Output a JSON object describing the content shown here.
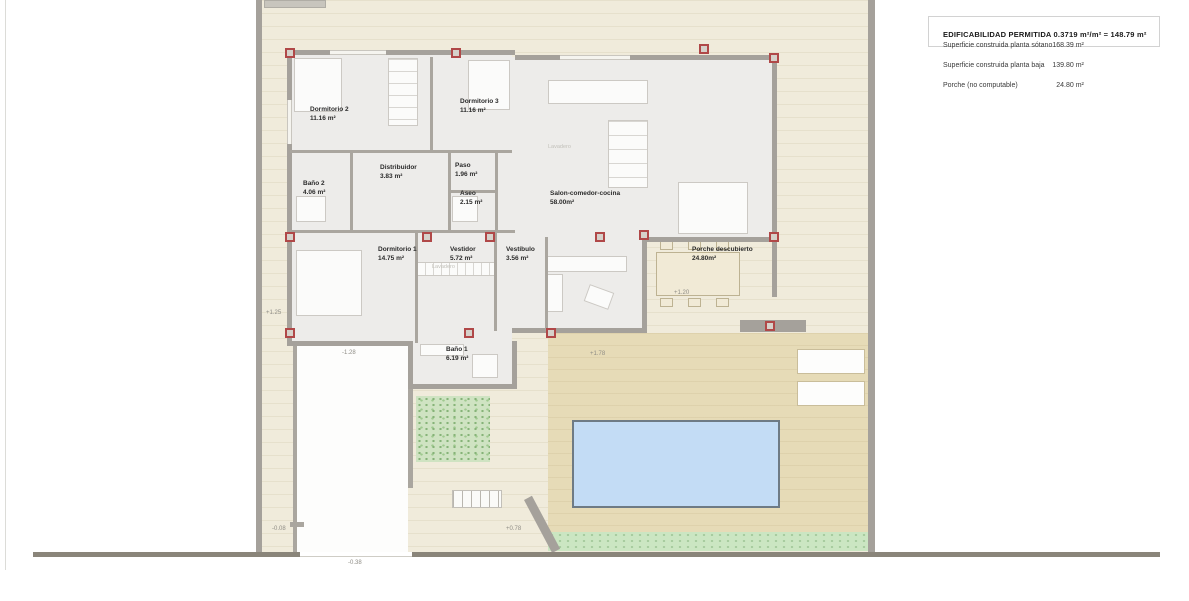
{
  "info_panel": {
    "title": "EDIFICABILIDAD PERMITIDA 0.3719 m²/m² = 148.79 m²",
    "rows": [
      {
        "label": "Superficie construida planta sótano",
        "value": "168.39 m²"
      },
      {
        "label": "Superficie construida planta baja",
        "value": "139.80 m²"
      },
      {
        "label": "Porche (no computable)",
        "value": "24.80 m²"
      }
    ]
  },
  "rooms": {
    "dormitorio2": {
      "name": "Dormitorio 2",
      "area": "11.16 m²"
    },
    "dormitorio3": {
      "name": "Dormitorio 3",
      "area": "11.16 m²"
    },
    "banio2": {
      "name": "Baño 2",
      "area": "4.06 m²"
    },
    "distribuidor": {
      "name": "Distribuidor",
      "area": "3.83 m²"
    },
    "paso": {
      "name": "Paso",
      "area": "1.96 m²"
    },
    "aseo": {
      "name": "Aseo",
      "area": "2.15 m²"
    },
    "salon": {
      "name": "Salon-comedor-cocina",
      "area": "58.00m²"
    },
    "dormitorio1": {
      "name": "Dormitorio 1",
      "area": "14.75 m²"
    },
    "vestidor": {
      "name": "Vestidor",
      "area": "5.72 m²"
    },
    "vestibulo": {
      "name": "Vestíbulo",
      "area": "3.56 m²"
    },
    "porche": {
      "name": "Porche descubierto",
      "area": "24.80m²"
    },
    "banio1": {
      "name": "Baño 1",
      "area": "6.19 m²"
    }
  },
  "faint_labels": {
    "laundry": "Lavadero"
  },
  "elevations": {
    "side_yard": "+1.25",
    "driveway": "-1.28",
    "porche": "+1.20",
    "terrace": "+1.78",
    "gate_left": "-0.08",
    "terrace_low": "+0.78",
    "street": "-0.38"
  },
  "colors": {
    "plot_beige": "#f0ebdb",
    "terrace_tan": "#e6dbb7",
    "grass_green": "#cbe6c2",
    "pool_blue": "#c3dcf5",
    "wall_gray": "#a5a19b",
    "boundary_dark": "#8a857a",
    "pillar_red": "#b04848"
  }
}
